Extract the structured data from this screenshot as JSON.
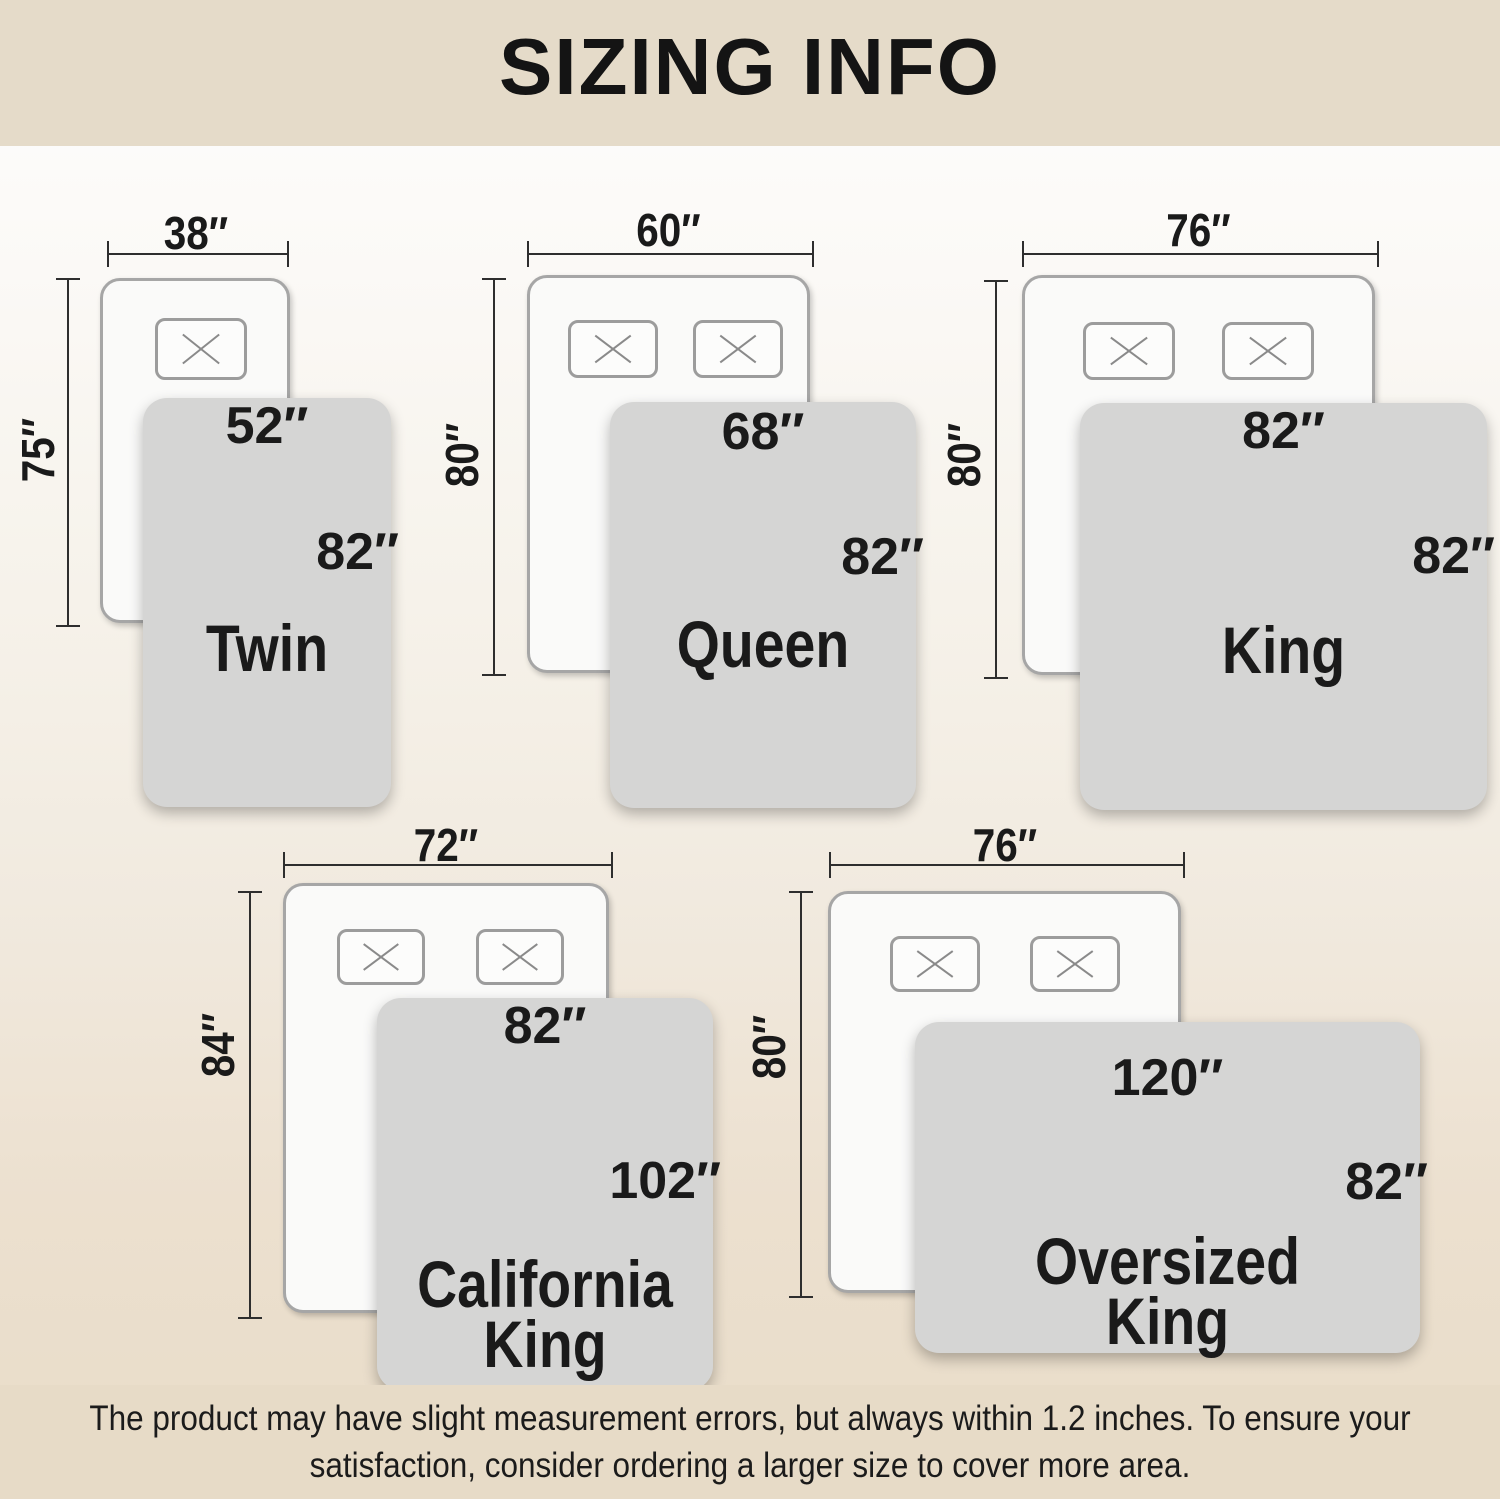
{
  "header": {
    "title": "SIZING INFO"
  },
  "footer": {
    "note": "The product may have slight measurement errors, but always within 1.2 inches. To ensure your\nsatisfaction, consider ordering a larger size to cover more area."
  },
  "colors": {
    "banner_bg": "#e5dbc9",
    "footer_bg": "#e7dbc7",
    "blanket": "#d5d5d4",
    "mattress": "#fafaf9",
    "line": "#2e2e2e",
    "text": "#1a1a1a"
  },
  "sizes": [
    {
      "name": "Twin",
      "mattress_width": "38″",
      "mattress_length": "75″",
      "blanket_width": "52″",
      "blanket_length": "82″",
      "pillow_count": 1
    },
    {
      "name": "Queen",
      "mattress_width": "60″",
      "mattress_length": "80″",
      "blanket_width": "68″",
      "blanket_length": "82″",
      "pillow_count": 2
    },
    {
      "name": "King",
      "mattress_width": "76″",
      "mattress_length": "80″",
      "blanket_width": "82″",
      "blanket_length": "82″",
      "pillow_count": 2
    },
    {
      "name": "California\nKing",
      "mattress_width": "72″",
      "mattress_length": "84″",
      "blanket_width": "82″",
      "blanket_length": "102″",
      "pillow_count": 2
    },
    {
      "name": "Oversized\nKing",
      "mattress_width": "76″",
      "mattress_length": "80″",
      "blanket_width": "120″",
      "blanket_length": "82″",
      "pillow_count": 2
    }
  ]
}
